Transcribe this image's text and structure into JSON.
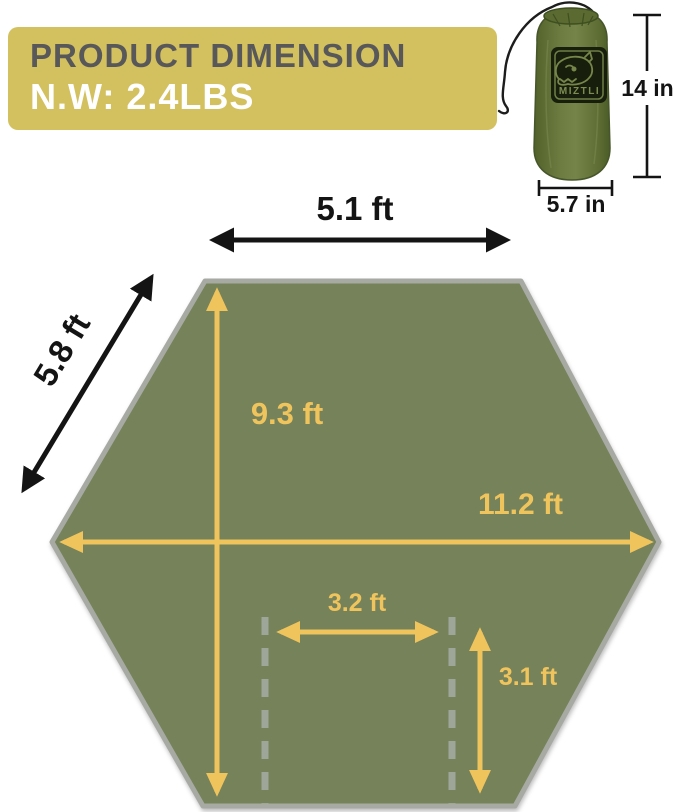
{
  "banner": {
    "title": "PRODUCT DIMENSION",
    "weight": "N.W: 2.4LBS",
    "bg_color": "#d3c05e",
    "title_color": "#58585a",
    "weight_color": "#ffffff"
  },
  "stuff_sack": {
    "brand": "MIZTLI",
    "height_label": "14 in",
    "width_label": "5.7 in",
    "bag_color": "#66763c"
  },
  "tarp": {
    "top_edge_label": "5.1 ft",
    "side_edge_label": "5.8 ft",
    "center_height_label": "9.3 ft",
    "max_width_label": "11.2 ft",
    "door_width_label": "3.2 ft",
    "door_height_label": "3.1 ft",
    "fill_color": "#75825a",
    "border_color": "#a7a9a3",
    "arrow_color": "#f0c45c",
    "black_dim_color": "#141414",
    "dashed_line_color": "#9ea69a",
    "shape": "hexagon"
  }
}
